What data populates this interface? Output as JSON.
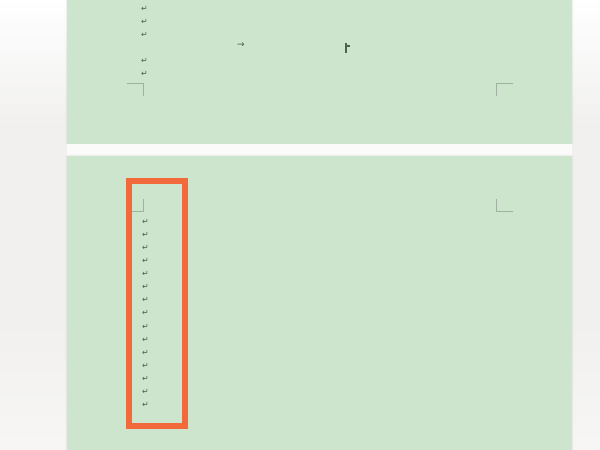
{
  "app": {
    "view": "word-processor-page-view",
    "page_color": "#cde5cd",
    "mark_color": "#4e6054",
    "boundary_mark_color": "#a2b0a2",
    "background_color": "#f1f0ef",
    "gap_color": "#fbfbfa"
  },
  "glyphs": {
    "line_break_mark": "↵",
    "tab_mark": "→"
  },
  "document": {
    "pages": [
      {
        "name": "page-1",
        "line_breaks": {
          "x": 141,
          "tops": [
            5,
            18,
            31,
            57,
            70
          ]
        },
        "tab_marks": [
          {
            "x": 237,
            "y": 41
          }
        ],
        "caret": {
          "x": 345,
          "y": 43,
          "height": 10
        },
        "boundary_corners": [
          {
            "x": 144,
            "y": 83,
            "h": "left",
            "v": "down"
          },
          {
            "x": 496,
            "y": 83,
            "h": "right",
            "v": "down"
          }
        ]
      },
      {
        "name": "page-2",
        "line_breaks": {
          "x": 142,
          "tops": [
            218,
            231,
            244,
            257,
            270,
            283,
            296,
            309,
            323,
            336,
            349,
            362,
            375,
            388,
            401
          ]
        },
        "tab_marks": [],
        "caret": null,
        "boundary_corners": [
          {
            "x": 144,
            "y": 212,
            "h": "left",
            "v": "up"
          },
          {
            "x": 496,
            "y": 212,
            "h": "right",
            "v": "up"
          }
        ]
      }
    ]
  },
  "annotation": {
    "highlight_box": {
      "left": 126,
      "top": 178,
      "width": 62,
      "height": 251,
      "border_width": 6,
      "color": "#f2693c"
    }
  }
}
